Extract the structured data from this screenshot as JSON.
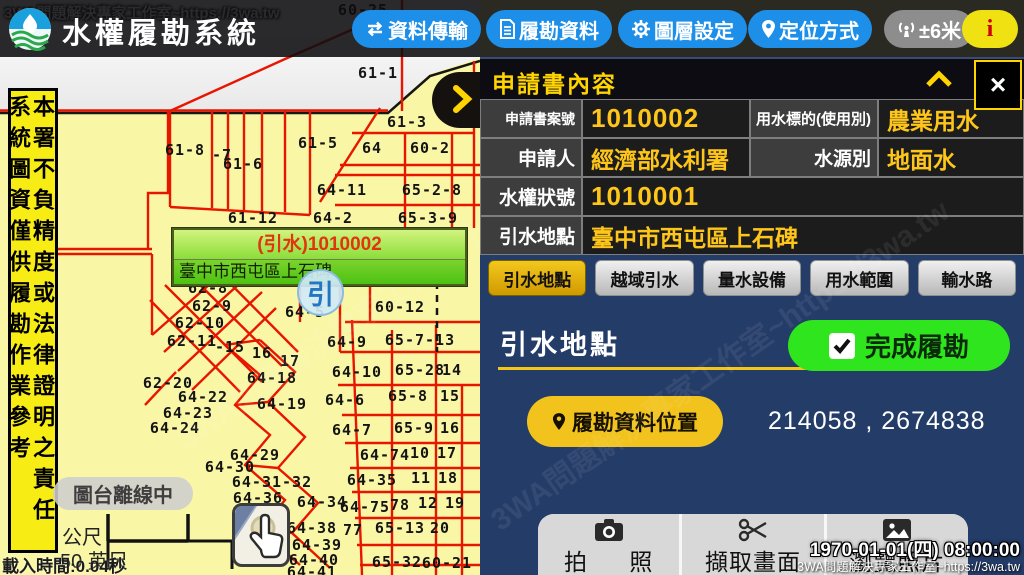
{
  "watermark": "3WA問題解決專家工作室~https://3wa.tw",
  "header": {
    "app_title": "水權履勘系統",
    "buttons": [
      {
        "label": "資料傳輸",
        "icon": "sync-icon"
      },
      {
        "label": "履勘資料",
        "icon": "document-icon"
      },
      {
        "label": "圖層設定",
        "icon": "gear-icon"
      },
      {
        "label": "定位方式",
        "icon": "location-pin-icon"
      }
    ],
    "accuracy_label": "±6米",
    "info_label": "i"
  },
  "map": {
    "tooltip": {
      "title": "(引水)1010002",
      "subtitle": "臺中市西屯區上石碑"
    },
    "marker_label": "引",
    "disclaimer_column_right": "本署不負精度或法律證明之責任",
    "disclaimer_column_left": "系統圖資僅供履勘作業參考",
    "offline_badge": "圖台離線中",
    "scale_meters_label": "公尺",
    "scale_feet_label": "50 英尺",
    "load_time": "載入時間:0.04秒",
    "parcels": [
      {
        "t": "60-25",
        "x": 363,
        "y": 10
      },
      {
        "t": "61-1",
        "x": 378,
        "y": 73
      },
      {
        "t": "61-3",
        "x": 407,
        "y": 122
      },
      {
        "t": "61-8",
        "x": 185,
        "y": 150
      },
      {
        "t": "-7",
        "x": 222,
        "y": 155
      },
      {
        "t": "61-6",
        "x": 243,
        "y": 164
      },
      {
        "t": "61-5",
        "x": 318,
        "y": 143
      },
      {
        "t": "64",
        "x": 372,
        "y": 148
      },
      {
        "t": "60-2",
        "x": 430,
        "y": 148
      },
      {
        "t": "64-11",
        "x": 342,
        "y": 190
      },
      {
        "t": "65-2-8",
        "x": 432,
        "y": 190
      },
      {
        "t": "61-12",
        "x": 253,
        "y": 218
      },
      {
        "t": "64-2",
        "x": 333,
        "y": 218
      },
      {
        "t": "65-3-9",
        "x": 428,
        "y": 218
      },
      {
        "t": "62-8",
        "x": 208,
        "y": 288
      },
      {
        "t": "62-9",
        "x": 212,
        "y": 306
      },
      {
        "t": "62-10",
        "x": 200,
        "y": 323
      },
      {
        "t": "62-11",
        "x": 192,
        "y": 341
      },
      {
        "t": "64-5",
        "x": 305,
        "y": 312
      },
      {
        "t": "60-12",
        "x": 400,
        "y": 307
      },
      {
        "t": "-15",
        "x": 230,
        "y": 347
      },
      {
        "t": "16",
        "x": 262,
        "y": 353
      },
      {
        "t": "17",
        "x": 290,
        "y": 361
      },
      {
        "t": "64-18",
        "x": 272,
        "y": 378
      },
      {
        "t": "64-9",
        "x": 347,
        "y": 342
      },
      {
        "t": "65-7-13",
        "x": 420,
        "y": 340
      },
      {
        "t": "64-10",
        "x": 357,
        "y": 372
      },
      {
        "t": "65-28",
        "x": 420,
        "y": 370
      },
      {
        "t": "14",
        "x": 452,
        "y": 370
      },
      {
        "t": "62-20",
        "x": 168,
        "y": 383
      },
      {
        "t": "64-22",
        "x": 203,
        "y": 397
      },
      {
        "t": "64-23",
        "x": 188,
        "y": 413
      },
      {
        "t": "64-24",
        "x": 175,
        "y": 428
      },
      {
        "t": "64-19",
        "x": 282,
        "y": 404
      },
      {
        "t": "64-6",
        "x": 345,
        "y": 400
      },
      {
        "t": "65-8",
        "x": 408,
        "y": 396
      },
      {
        "t": "15",
        "x": 450,
        "y": 396
      },
      {
        "t": "64-7",
        "x": 352,
        "y": 430
      },
      {
        "t": "65-9",
        "x": 414,
        "y": 428
      },
      {
        "t": "16",
        "x": 450,
        "y": 428
      },
      {
        "t": "64-29",
        "x": 255,
        "y": 455
      },
      {
        "t": "64-30",
        "x": 230,
        "y": 467
      },
      {
        "t": "64-74",
        "x": 385,
        "y": 455
      },
      {
        "t": "10",
        "x": 420,
        "y": 453
      },
      {
        "t": "17",
        "x": 447,
        "y": 453
      },
      {
        "t": "64-31-32",
        "x": 272,
        "y": 482
      },
      {
        "t": "64-35",
        "x": 372,
        "y": 480
      },
      {
        "t": "11",
        "x": 421,
        "y": 478
      },
      {
        "t": "18",
        "x": 448,
        "y": 478
      },
      {
        "t": "64-36",
        "x": 258,
        "y": 498
      },
      {
        "t": "64-55",
        "x": 262,
        "y": 513
      },
      {
        "t": "64-34",
        "x": 322,
        "y": 502
      },
      {
        "t": "64-75",
        "x": 365,
        "y": 507
      },
      {
        "t": "78",
        "x": 400,
        "y": 505
      },
      {
        "t": "12",
        "x": 428,
        "y": 503
      },
      {
        "t": "19",
        "x": 455,
        "y": 503
      },
      {
        "t": "64-38",
        "x": 312,
        "y": 528
      },
      {
        "t": "77",
        "x": 353,
        "y": 530
      },
      {
        "t": "65-13",
        "x": 400,
        "y": 528
      },
      {
        "t": "20",
        "x": 440,
        "y": 528
      },
      {
        "t": "64-39",
        "x": 317,
        "y": 545
      },
      {
        "t": "64-40",
        "x": 314,
        "y": 560
      },
      {
        "t": "64-41",
        "x": 312,
        "y": 572
      },
      {
        "t": "65-32",
        "x": 397,
        "y": 562
      },
      {
        "t": "60-21",
        "x": 447,
        "y": 563
      }
    ]
  },
  "panel": {
    "title": "申請書內容",
    "close_label": "×",
    "form": {
      "case_label": "申請書案號",
      "case_value": "1010002",
      "purpose_label": "用水標的(使用別)",
      "purpose_value": "農業用水",
      "applicant_label": "申請人",
      "applicant_value": "經濟部水利署",
      "source_label": "水源別",
      "source_value": "地面水",
      "license_label": "水權狀號",
      "license_value": "1010001",
      "location_label": "引水地點",
      "location_value": "臺中市西屯區上石碑"
    },
    "tabs": [
      "引水地點",
      "越域引水",
      "量水設備",
      "用水範圍",
      "輸水路"
    ],
    "section_title": "引水地點",
    "complete_button": "完成履勘",
    "location_button": "履勘資料位置",
    "coordinates": "214058 , 2674838",
    "actions": {
      "photo": "拍 照",
      "capture": "擷取畫面",
      "browse": "瀏覽照片"
    },
    "datetime": "1970-01-01(四) 08:00:00"
  }
}
